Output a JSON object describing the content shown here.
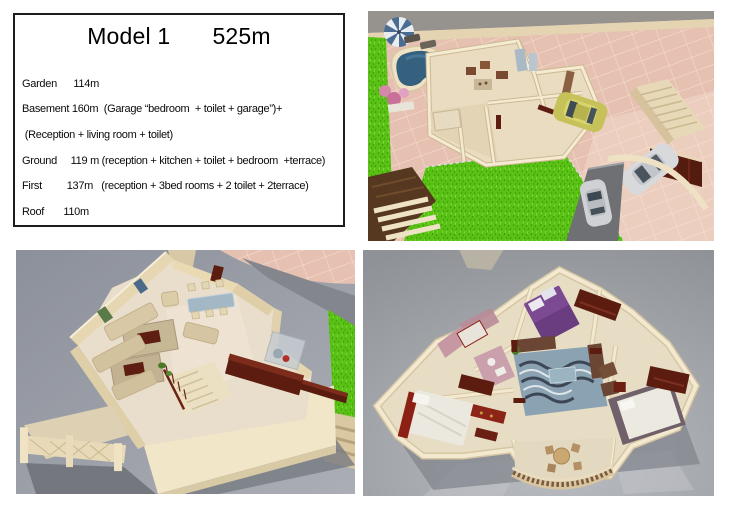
{
  "info_box": {
    "title": "Model 1",
    "area": "525m",
    "lines": [
      "Garden      114m",
      "Basement 160m  (Garage “bedroom  + toilet + garage”)+",
      " (Reception + living room + toilet)",
      "Ground     119 m (reception + kitchen + toilet + bedroom  +terrace)",
      "First         137m   (reception + 3bed rooms + 2 toilet + 2terrace)",
      "Roof       110m"
    ]
  },
  "palette": {
    "tile_pink": "#e6c0b0",
    "grass_green": "#5ac215",
    "pool_blue": "#35617f",
    "wall_cream": "#ecdfbe",
    "floor_beige": "#e8dcc4",
    "maroon_wood": "#5c1c0f",
    "car_yellow": "#c6c259",
    "car_silver": "#d2d4d6",
    "render_background_grey": "#9296a1",
    "purple_bed": "#7c4a92",
    "rug_blue": "#8aa2b2"
  }
}
